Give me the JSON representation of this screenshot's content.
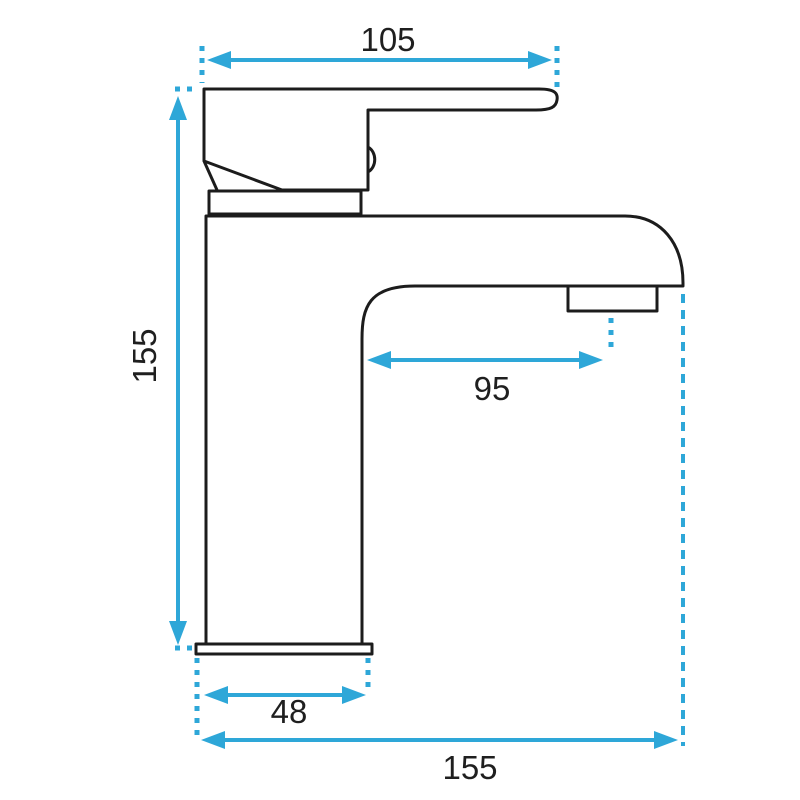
{
  "drawing": {
    "labels": {
      "top_width": "105",
      "height": "155",
      "spout_reach": "95",
      "base_width": "48",
      "overall_depth": "155"
    },
    "colors": {
      "outline": "#1c1c1c",
      "dimension": "#2ea7d8",
      "label_text": "#1f1f1f",
      "background": "#ffffff"
    }
  }
}
